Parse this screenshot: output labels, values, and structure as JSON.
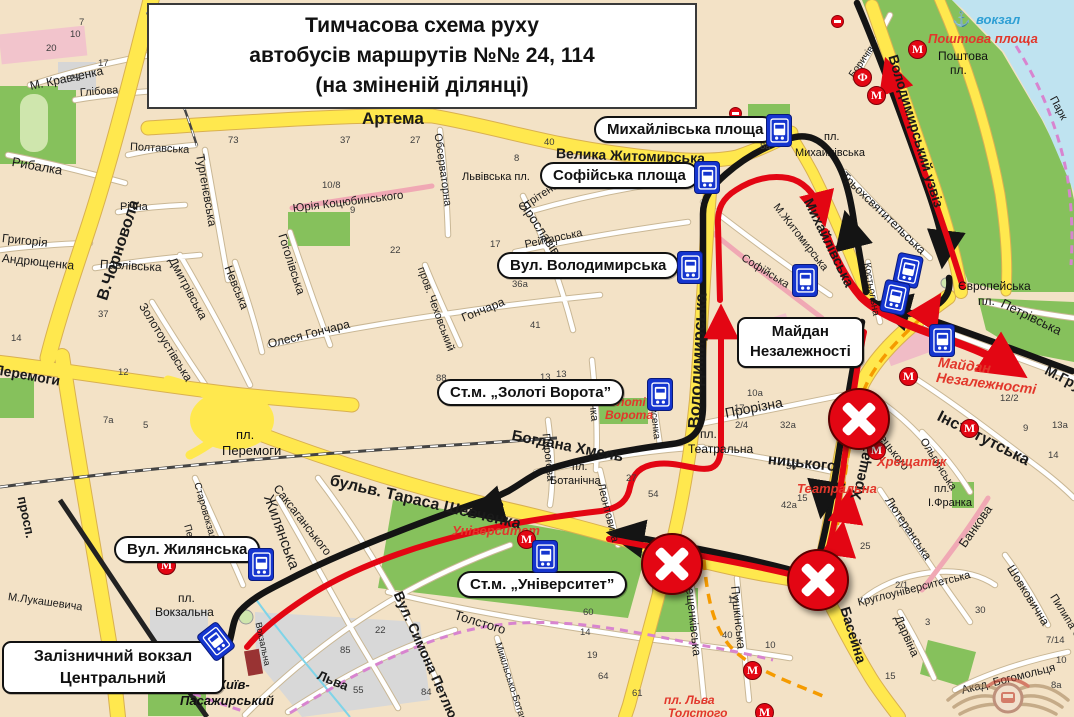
{
  "title": {
    "line1": "Тимчасова схема руху",
    "line2": "автобусів маршрутів №№ 24, 114",
    "line3": "(на зміненій ділянці)"
  },
  "callouts": {
    "mykhailivska_ploshcha": "Михайлівська площа",
    "sofiiska_ploshcha": "Софійська площа",
    "vul_volodymyrska": "Вул. Володимирська",
    "stm_zoloti_vorota": "Ст.м. „Золоті Ворота”",
    "maidan_line1": "Майдан",
    "maidan_line2": "Незалежності",
    "vul_zhylianska": "Вул. Жилянська",
    "stm_universytet": "Ст.м. „Університет”",
    "vokzal_line1": "Залізничний вокзал",
    "vokzal_line2": "Центральний"
  },
  "streets": {
    "artema": "Артема",
    "chornovola": "В.Чорновола",
    "volodymyrska": "Володимирська",
    "khreshchatyk": "Хрещатик",
    "uzviz": "Володимирський узвіз",
    "shevchenka": "бульв. Тараса Шевченка",
    "zhytomyrska": "Велика Житомирська",
    "bohdana": "Богдана Хмель",
    "nytskoho": "ницького",
    "petliury": "Вул. Симона Петлюри",
    "baseina": "Басейна",
    "mykhailivska": "Михайлівська",
    "instytutska": "Інститутська",
    "peremohy": "Перемоги",
    "prosp": "просп.",
    "hrushevskoho": "М.Грушевського",
    "kravchenka": "М. Кравченка",
    "hlibova": "Глібова",
    "rybalka": "Рибалка",
    "hryhoriia": "Григорія",
    "andriushchenka": "Андрющенка",
    "pavlivska": "Павлівська",
    "richna": "Річна",
    "poltavska": "Полтавська",
    "turhenievska": "Тургенєвська",
    "dmytrivska": "Дмитрівська",
    "zolotoustivska": "Золотоустівська",
    "nevska": "Невська",
    "hoholivska": "Гоголівська",
    "kotsiubynskoho": "Юрія Коцюбинського",
    "observatorna": "Обсерваторна",
    "chekhovskyi": "пров. Чеховський",
    "honchara": "Олеся Гончара",
    "honchara2": "Гончара",
    "stritenska": "Стрітенська",
    "reitarska": "Рейтарська",
    "yaroslaviv": "Ярославів Вал",
    "franka": "Франка",
    "pyrohova": "Пирогова",
    "lysenka": "Лисенка",
    "leontovycha": "Леонтовича",
    "tereshchenkivska": "Терещенківська",
    "pushkinska": "Пушкінська",
    "tolstoho": "Толстого",
    "mykilska": "Микільсько-Ботанічна",
    "saksahanskoho": "Саксаганського",
    "zhylianska": "Жилянська",
    "starovokzalna": "Старовокзальна",
    "pestelia": "Пестеля",
    "lukashevycha": "М.Лукашевича",
    "lva": "Льва",
    "vokzalna": "Вокзальна",
    "petrivska": "Петрівська",
    "trokhsviatytelska": "Трьохсвятительська",
    "mzhytomyrska": "М.Житомирська",
    "sofiiska": "Софійська",
    "kostolna": "Костьольна",
    "prorizna": "Прорізна",
    "horodetskoho": "арх.Городецького",
    "olhynska": "Ольгинська",
    "liuteranska": "Лютеранська",
    "bankova": "Банкова",
    "kruhlo": "Круглоуніверситетська",
    "shovkovychna": "Шовковична",
    "pylypa": "Пилипа Орлика",
    "darvina": "Дарвіна",
    "bohomoltsia": "Акад. Богомольця",
    "borychiv": "Боричів",
    "park": "Парк"
  },
  "places": {
    "pl_mykhailivska_1": "пл.",
    "pl_mykhailivska_2": "Михайлівська",
    "lvivska_pl": "Львівська пл.",
    "pl_peremohy_1": "пл.",
    "pl_peremohy_2": "Перемоги",
    "pl_vokzalna_1": "пл.",
    "pl_vokzalna_2": "Вокзальна",
    "pl_botanichna_1": "пл.",
    "pl_botanichna_2": "Ботанічна",
    "pl_teatralna_1": "пл.",
    "pl_teatralna_2": "Театральна",
    "yevropeiska_1": "Європейська",
    "yevropeiska_2": "пл.",
    "pl_franka_1": "пл.",
    "pl_franka_2": "І.Франка",
    "poshtova_pl_1": "Поштова",
    "poshtova_pl_2": "пл.",
    "kyiv_pas_1": "Київ-",
    "kyiv_pas_2": "Пасажирський"
  },
  "stations": {
    "poshtova": "Поштова площа",
    "zoloti_1": "Золоті",
    "zoloti_2": "Ворота",
    "universytet": "Університет",
    "khreshchatyk": "Хрещатик",
    "teatralna": "Театральна",
    "maidan_1": "Майдан",
    "maidan_2": "Незалежності",
    "tolstoho_1": "пл. Льва",
    "tolstoho_2": "Толстого"
  },
  "river_port": {
    "anchor": "⚓",
    "label": "вокзал"
  },
  "icons": {
    "metro": "М",
    "funicular": "Ф"
  },
  "colors": {
    "route_black": "#141414",
    "route_red": "#e30613",
    "closed_marker": "#e30613",
    "bus_stop_blue": "#1535cf",
    "highway_yellow": "#ffe84e",
    "park_green": "#86c15c",
    "water_blue": "#bfe3f0"
  },
  "house_numbers": [
    "20",
    "10",
    "23",
    "17",
    "7",
    "73",
    "37",
    "27",
    "10/8",
    "9",
    "22",
    "8",
    "40",
    "8а",
    "17",
    "36а",
    "41",
    "13",
    "88",
    "13",
    "54",
    "27",
    "14",
    "37",
    "12",
    "7а",
    "5",
    "32а",
    "36",
    "42а",
    "25",
    "2/1",
    "12/2",
    "9",
    "13а",
    "14",
    "17",
    "10а",
    "2/4",
    "15",
    "60",
    "14",
    "19",
    "64",
    "61",
    "13",
    "40",
    "10",
    "15",
    "3",
    "30",
    "7/14",
    "10",
    "8а",
    "85",
    "22",
    "84",
    "55"
  ]
}
